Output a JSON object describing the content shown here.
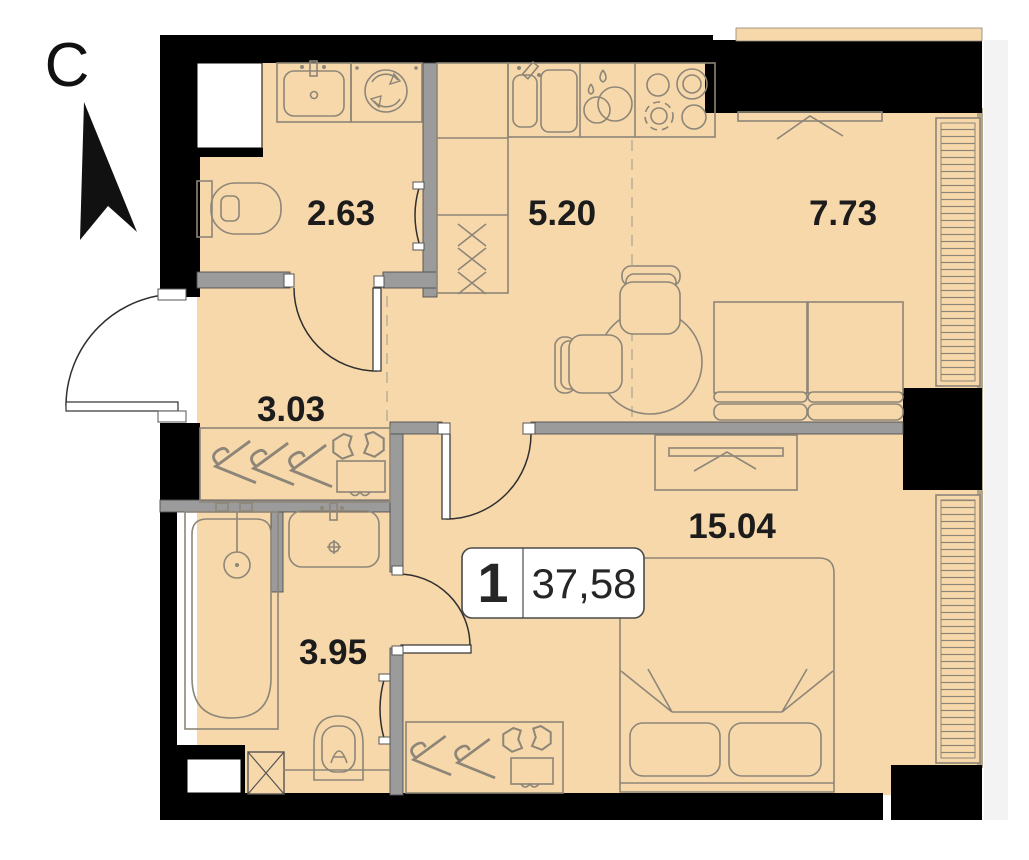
{
  "compass": {
    "label": "С"
  },
  "unit_badge": {
    "rooms_count": "1",
    "total_area": "37,58"
  },
  "room_areas": {
    "wc": "2.63",
    "kitchen": "5.20",
    "living": "7.73",
    "hallway": "3.03",
    "bedroom": "15.04",
    "bathroom": "3.95"
  },
  "colors": {
    "floor": "#f7d8ab",
    "exterior_wall": "#000000",
    "interior_wall": "#9b9b9b",
    "furniture_outline": "#8d8678",
    "label_text": "#1c1c1c",
    "badge_background": "#ffffff"
  }
}
